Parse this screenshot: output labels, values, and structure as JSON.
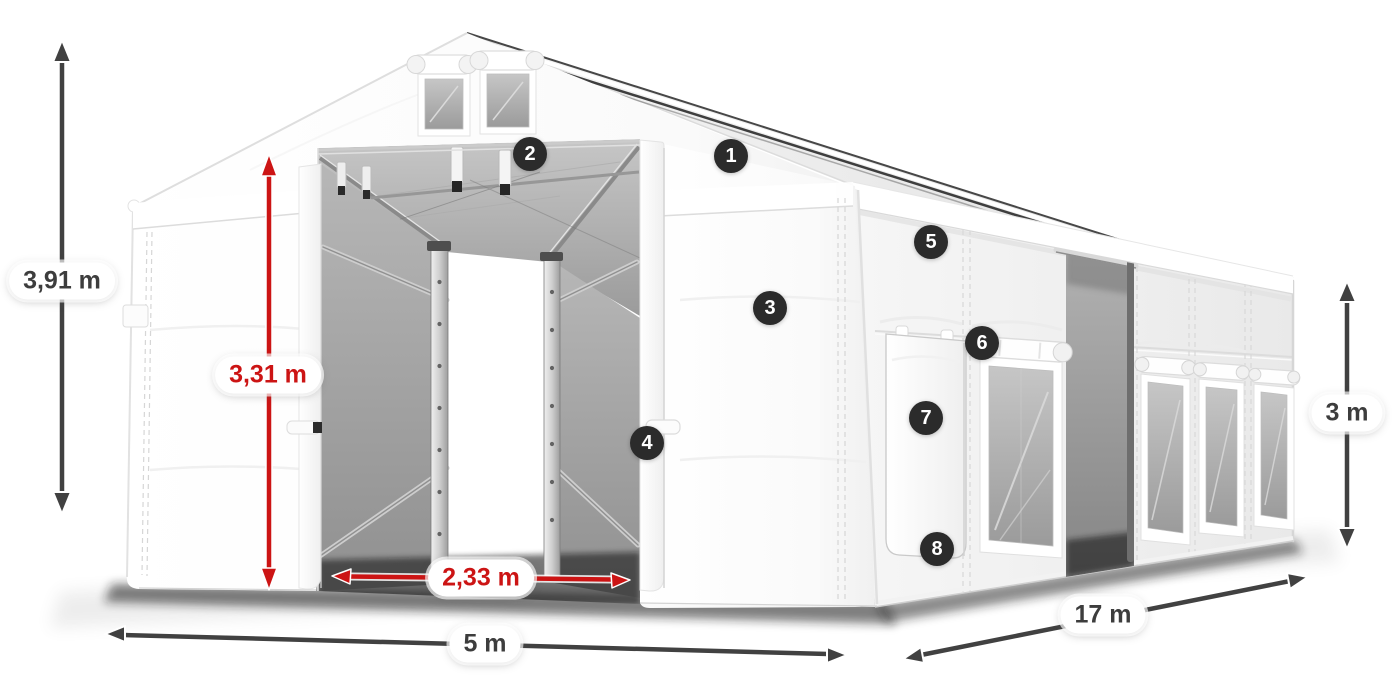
{
  "dimensions": {
    "total_height": "3,91 m",
    "entrance_height": "3,31 m",
    "entrance_width": "2,33 m",
    "front_width": "5 m",
    "length": "17 m",
    "side_height": "3 m"
  },
  "markers": {
    "m1": "1",
    "m2": "2",
    "m3": "3",
    "m4": "4",
    "m5": "5",
    "m6": "6",
    "m7": "7",
    "m8": "8"
  },
  "colors": {
    "dimension_dark": "#414141",
    "dimension_red": "#cc1414",
    "marker_background": "#2b2b2b",
    "marker_text": "#ffffff",
    "tent_surface": "#ffffff",
    "interior_mesh": "#a8a8a8"
  }
}
